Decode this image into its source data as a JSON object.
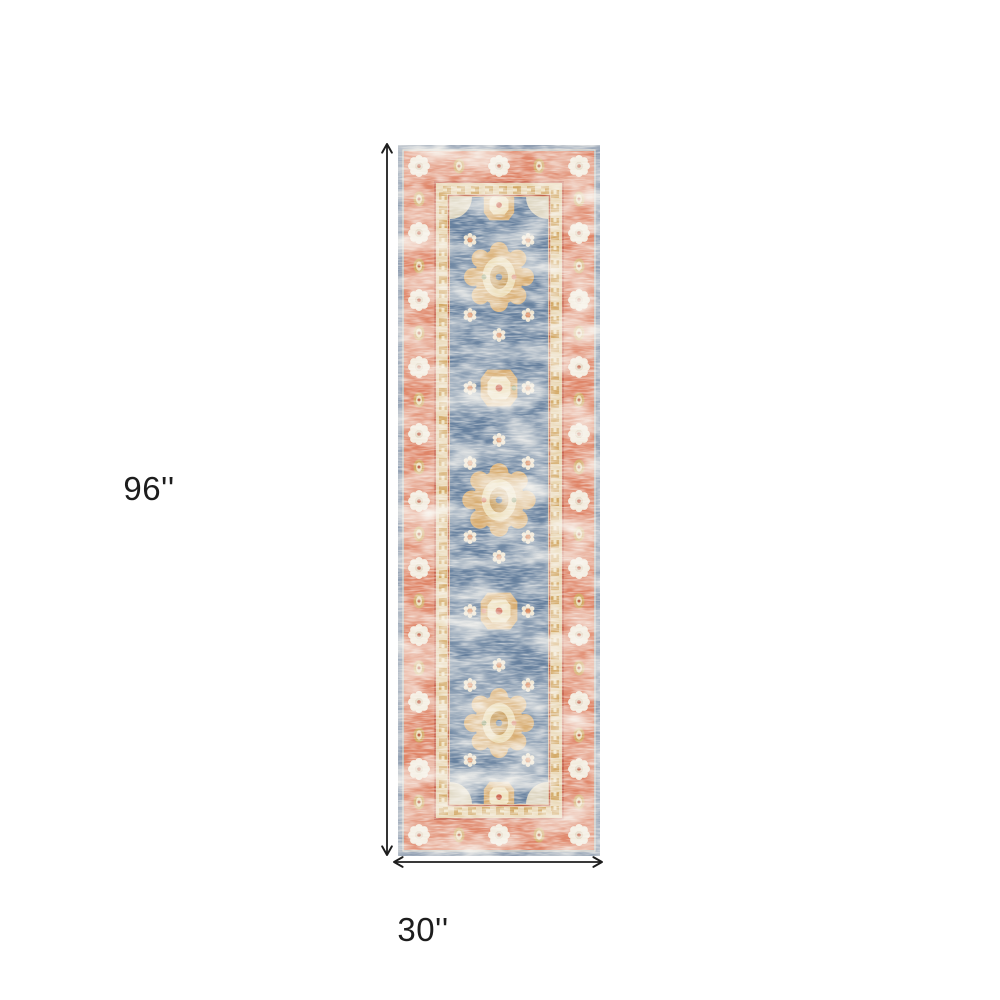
{
  "diagram": {
    "background_color": "#ffffff",
    "annotation_color": "#1d1d1d",
    "height": {
      "label": "96''"
    },
    "width": {
      "label": "30''"
    }
  },
  "rug": {
    "description": "distressed-vintage-oriental-runner-rug",
    "palette": {
      "outer_band": "#8e9db1",
      "border": "#df8568",
      "border_accent_red": "#c96752",
      "guard_band": "#e7d3ac",
      "field": "#66809e",
      "motif_gold": "#d2a763",
      "motif_cream": "#f0e6d1",
      "motif_orange": "#dc8a5e"
    }
  }
}
